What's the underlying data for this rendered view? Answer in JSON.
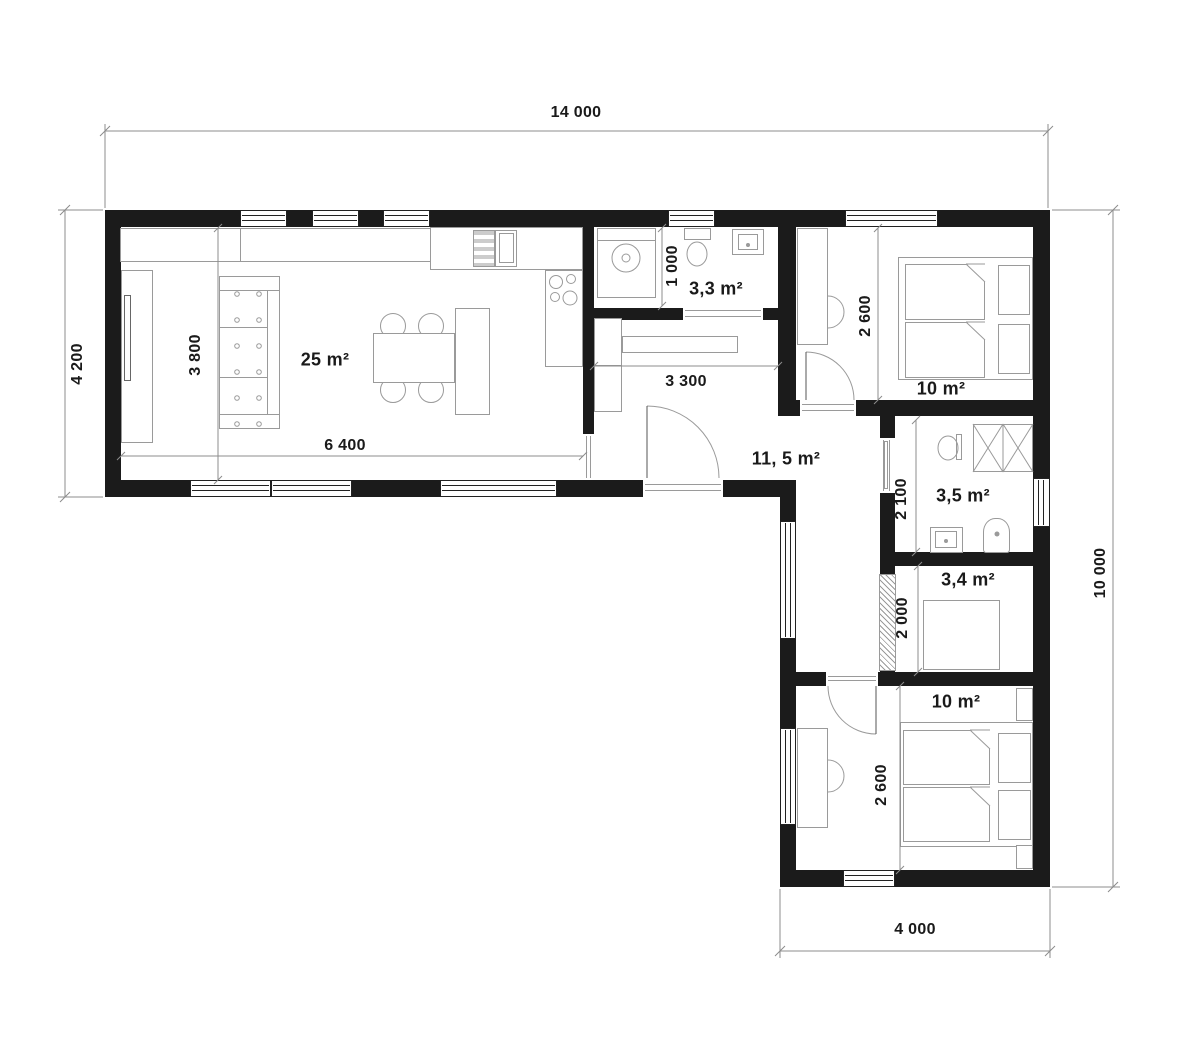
{
  "plan": {
    "type": "architectural-floor-plan",
    "colors": {
      "wall": "#1b1b1b",
      "furniture_line": "#9a9a9a",
      "dimension_line": "#8c8c8c",
      "text": "#1a1a1a",
      "background": "#ffffff"
    },
    "exterior_dimensions": {
      "top": "14 000",
      "left": "4 200",
      "right": "10 000",
      "bottom": "4 000"
    },
    "interior_dimensions": {
      "living_width": "6 400",
      "living_depth": "3 800",
      "bath_small_depth": "1 000",
      "hall_width": "3 300",
      "bedroom_top_depth": "2 600",
      "bath_depth": "2 100",
      "closet_depth": "2 000",
      "bedroom_bottom_depth": "2 600"
    },
    "rooms": [
      {
        "name": "living-kitchen",
        "area_label": "25 m²"
      },
      {
        "name": "bathroom-small",
        "area_label": "3,3 m²"
      },
      {
        "name": "hall",
        "area_label": "11, 5 m²"
      },
      {
        "name": "bedroom-top",
        "area_label": "10 m²"
      },
      {
        "name": "bathroom",
        "area_label": "3,5 m²"
      },
      {
        "name": "closet",
        "area_label": "3,4 m²"
      },
      {
        "name": "bedroom-bottom",
        "area_label": "10 m²"
      }
    ],
    "fixtures": [
      "media-unit",
      "tv",
      "wardrobe-cabinet",
      "dining-table",
      "dining-chairs",
      "kitchen-counter",
      "fridge",
      "stove",
      "kitchen-island",
      "washing-machine",
      "toilet",
      "sink",
      "shower",
      "boiler",
      "double-bed",
      "nightstand",
      "desk",
      "desk-chair",
      "wardrobe",
      "entrance-door",
      "interior-door",
      "sliding-door"
    ]
  }
}
